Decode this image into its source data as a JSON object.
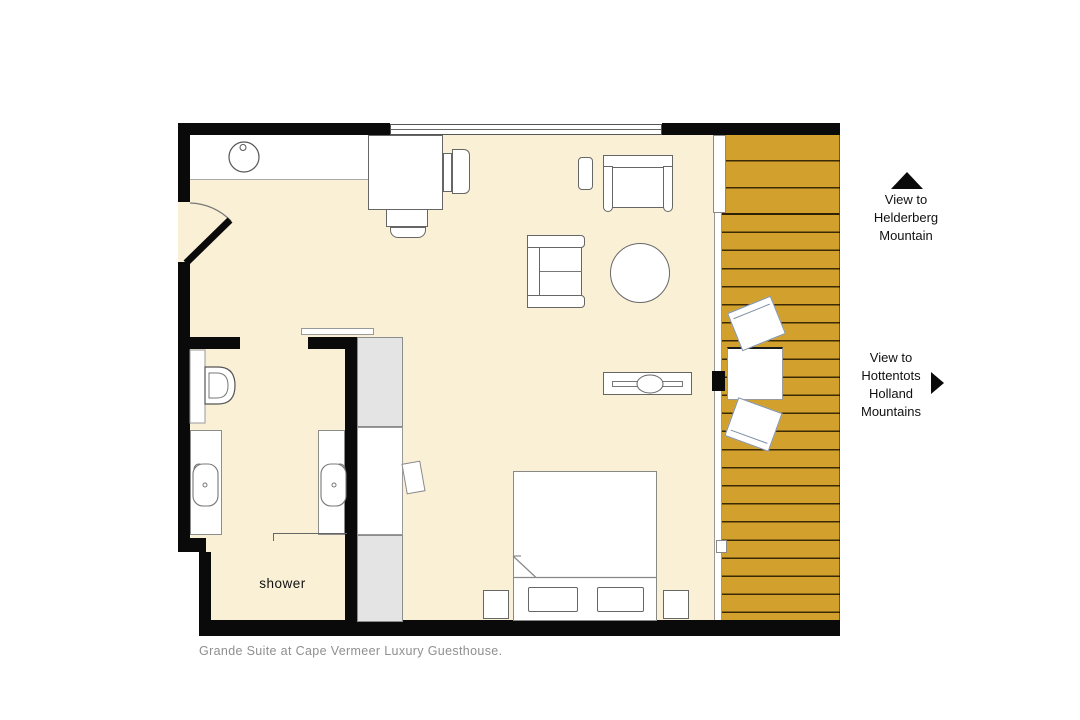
{
  "caption": "Grande Suite at Cape Vermeer Luxury Guesthouse.",
  "labels": {
    "shower": "shower",
    "view_helderberg": {
      "line1": "View to",
      "line2": "Helderberg",
      "line3": "Mountain"
    },
    "view_hottentots": {
      "line1": "View to",
      "line2": "Hottentots",
      "line3": "Holland",
      "line4": "Mountains"
    }
  },
  "colors": {
    "floor": "#FAF0D6",
    "deck": "#D2A02C",
    "deck_slat": "#3A2A05",
    "wall": "#0A0A0A",
    "closet_fill": "#E4E4E4",
    "outline": "#666666",
    "outline_light": "#999999",
    "deck_furniture_outline": "#7E90A8",
    "label_text": "#111111",
    "caption_text": "#8F8F8F"
  }
}
